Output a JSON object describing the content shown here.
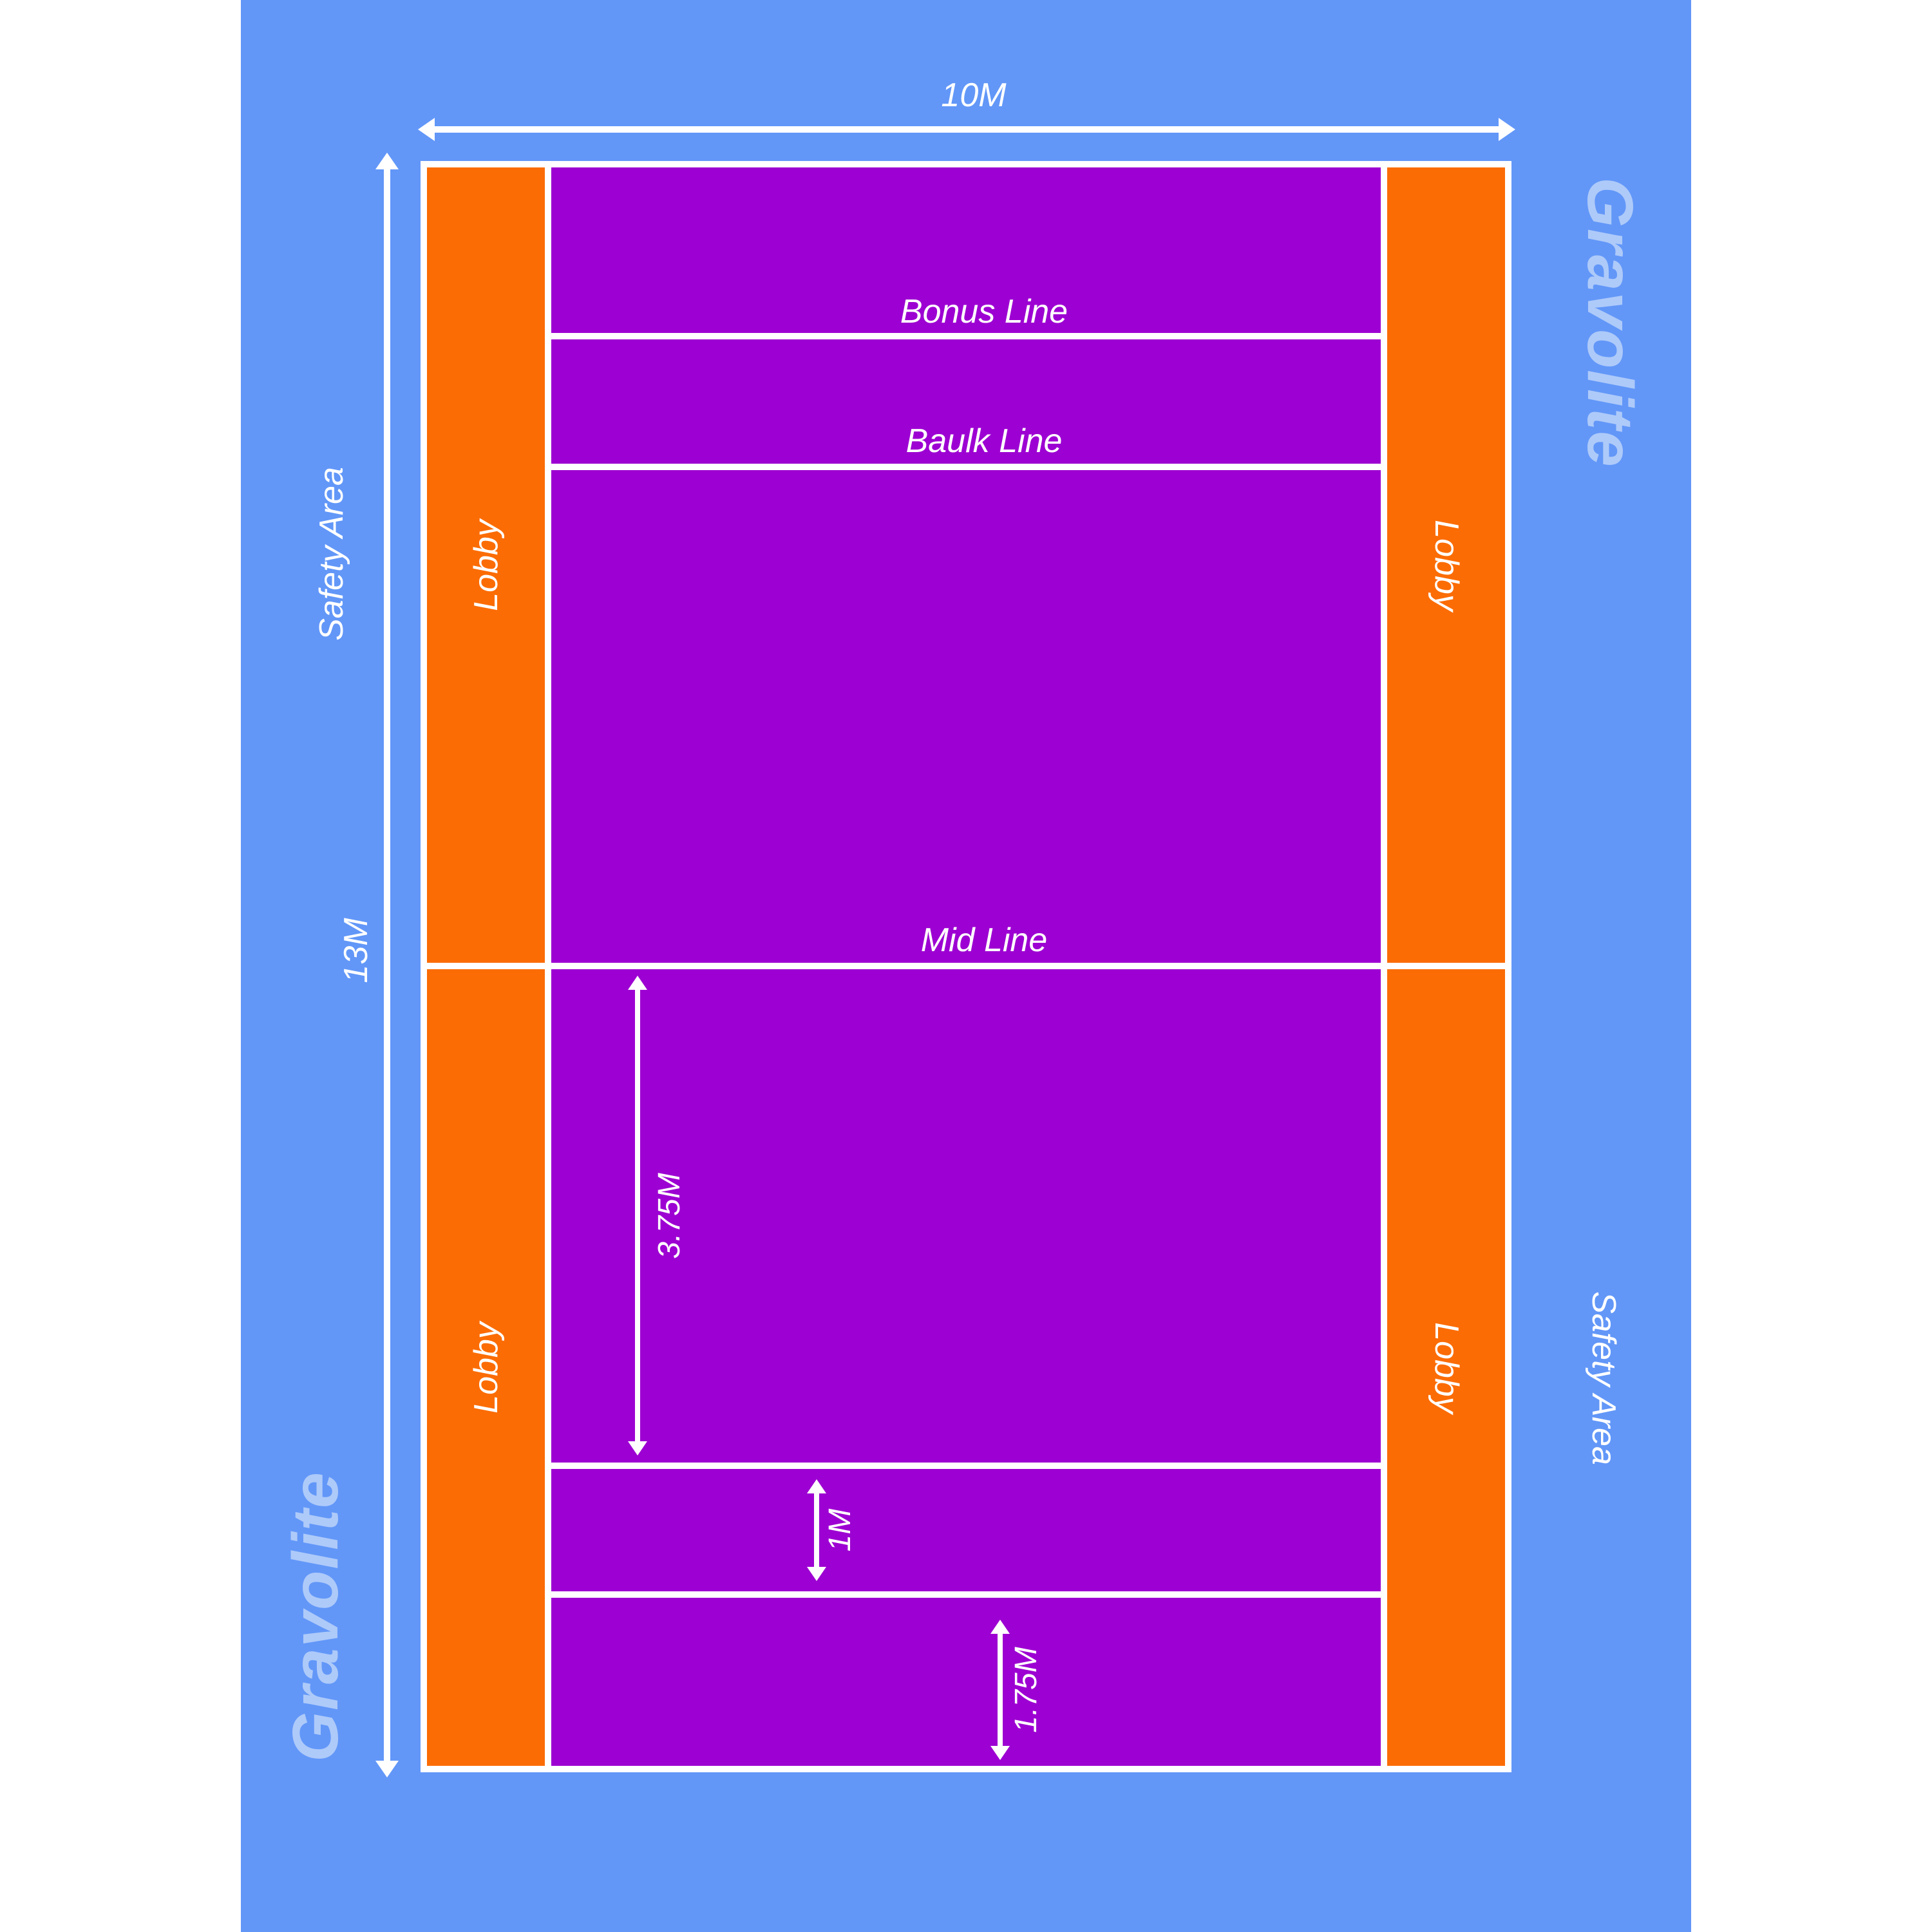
{
  "brand": {
    "watermark_left": "Gravolite",
    "watermark_right": "Gravolite"
  },
  "colors": {
    "safety_area_blue": "#6297F8",
    "lobby_orange": "#FB6C04",
    "field_purple": "#9D00D2",
    "line_white": "#FFFFFF",
    "watermark_blue": "#AECAF9"
  },
  "safety": {
    "left_label": "Safety Area",
    "right_label": "Safety Area"
  },
  "dimensions": {
    "court_width": "10M",
    "court_height": "13M",
    "mid_to_baulk": "3.75M",
    "baulk_to_bonus": "1M",
    "bonus_to_end": "1.75M"
  },
  "court": {
    "lines": {
      "bonus": "Bonus Line",
      "baulk": "Baulk Line",
      "mid": "Mid Line"
    },
    "lobbies": {
      "left_top": "Lobby",
      "left_bottom": "Lobby",
      "right_top": "Lobby",
      "right_bottom": "Lobby"
    }
  }
}
